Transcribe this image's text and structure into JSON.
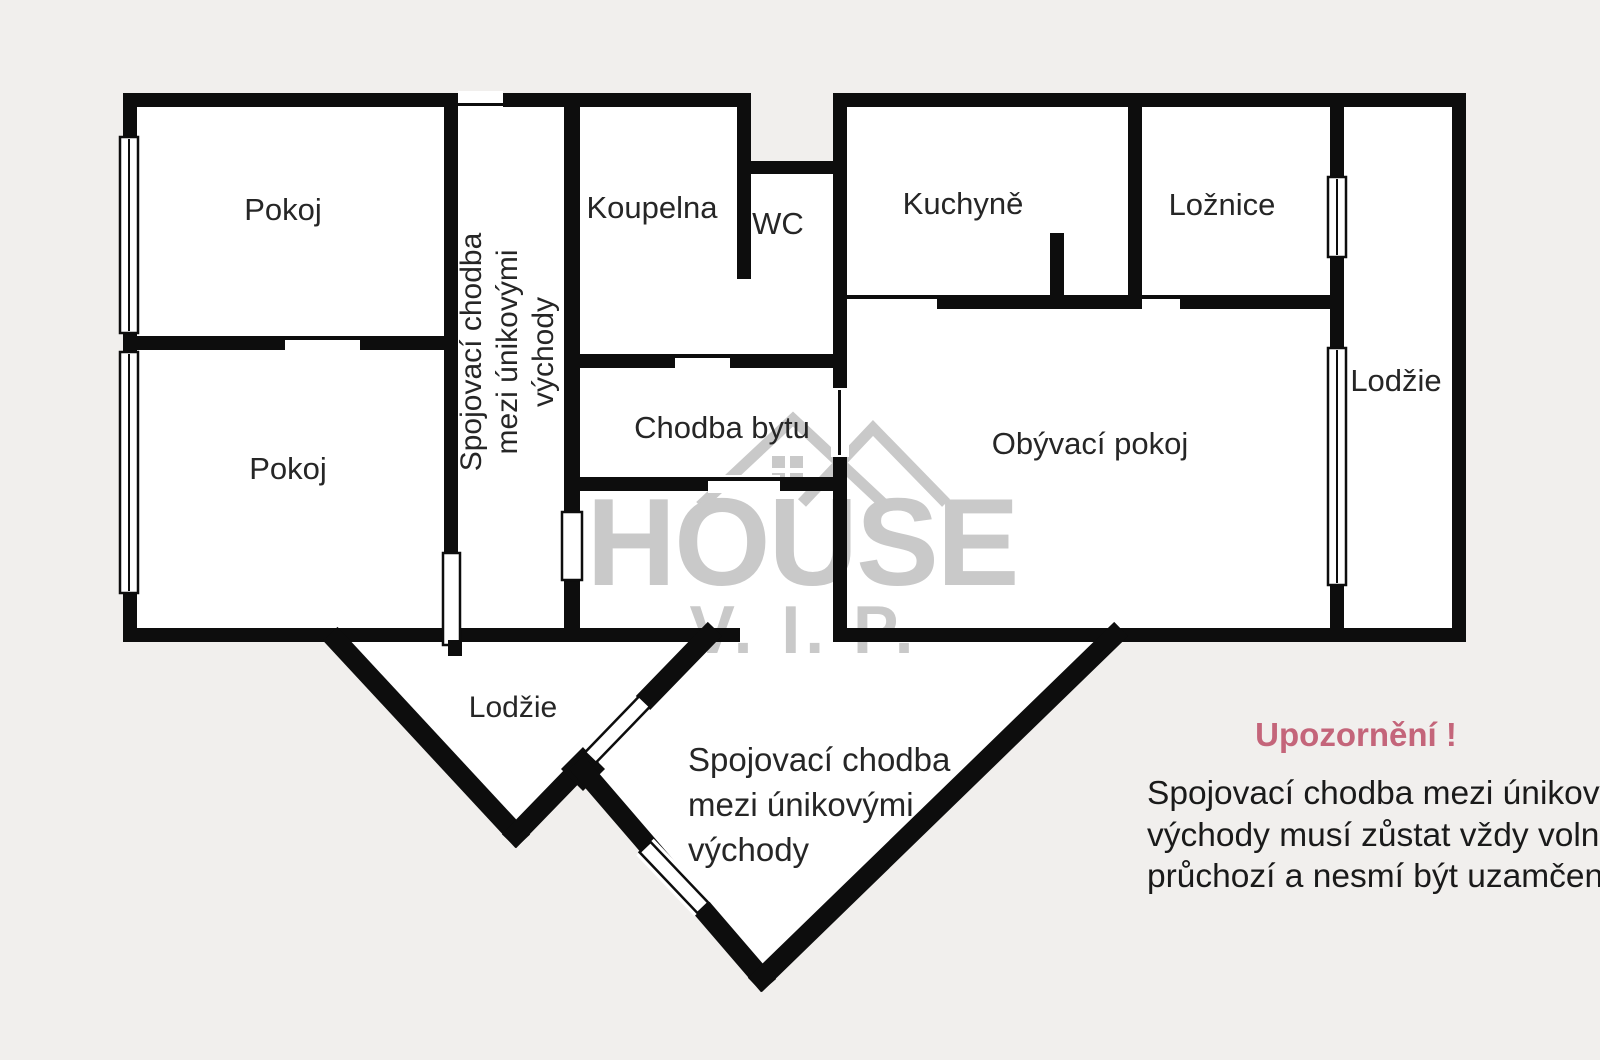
{
  "colors": {
    "bg": "#f1efed",
    "wall": "#0d0d0d",
    "room": "#ffffff",
    "watermark": "#c9c9c9",
    "accent-red": "#c4657a",
    "label": "#262626",
    "text": "#1a1a1a"
  },
  "rooms": {
    "pokoj_top": {
      "label": "Pokoj"
    },
    "pokoj_bottom": {
      "label": "Pokoj"
    },
    "koupelna": {
      "label": "Koupelna"
    },
    "wc": {
      "label": "WC"
    },
    "kuchyne": {
      "label": "Kuchyně"
    },
    "loznice": {
      "label": "Ložnice"
    },
    "lodzie_right": {
      "label": "Lodžie"
    },
    "chodba_bytu": {
      "label": "Chodba bytu"
    },
    "obyvaci_pokoj": {
      "label": "Obývací pokoj"
    },
    "lodzie_bottom": {
      "label": "Lodžie"
    },
    "corridor_vertical": {
      "lines": [
        "Spojovací chodba",
        "mezi únikovými",
        "východy"
      ]
    },
    "corridor_diamond": {
      "lines": [
        "Spojovací chodba",
        "mezi únikovými",
        "východy"
      ]
    }
  },
  "watermark": {
    "brand": "HOUSE",
    "sub": "V. I. P."
  },
  "warning": {
    "title": "Upozornění !",
    "lines": [
      "Spojovací chodba mezi únikovými",
      "východy musí zůstat vždy volně",
      "průchozí a nesmí být uzamčena"
    ]
  }
}
